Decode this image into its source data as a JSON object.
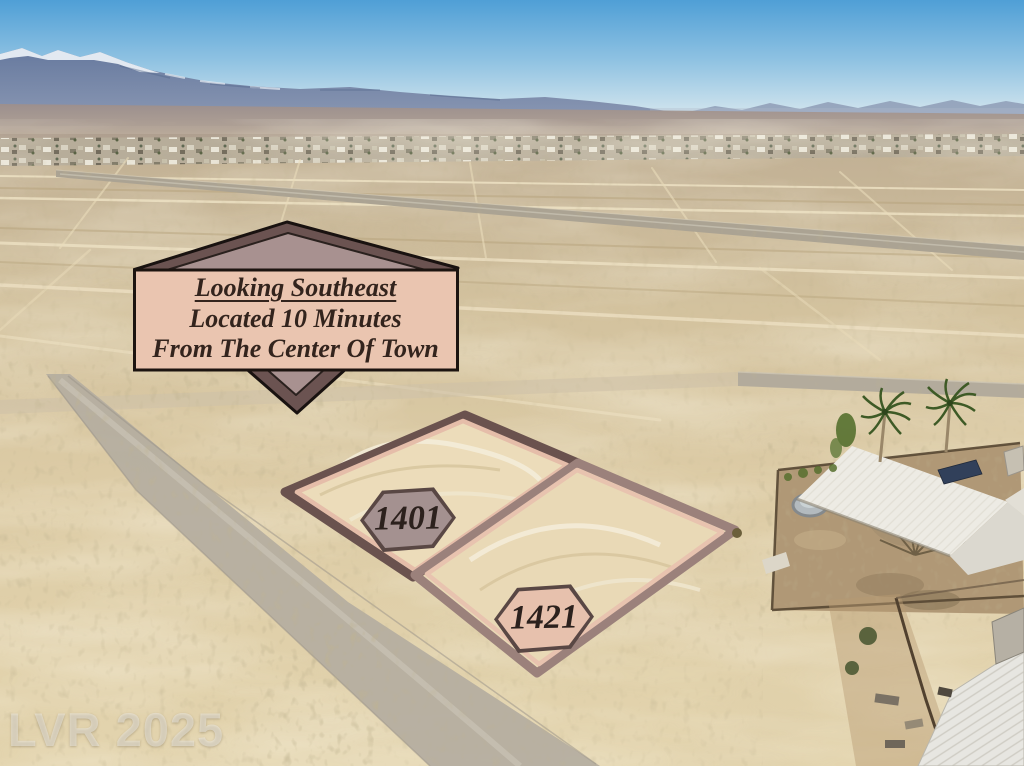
{
  "banner": {
    "line1": "Looking Southeast",
    "line2": "Located 10 Minutes",
    "line3": "From The Center Of Town"
  },
  "lots": [
    {
      "label": "1401"
    },
    {
      "label": "1421"
    }
  ],
  "watermark": "LVR 2025",
  "colors": {
    "banner_outer": "#6b5351",
    "banner_inner_triangle": "#a89190",
    "banner_panel": "#eac5b0",
    "badge_border": "#594744",
    "badge_1401_fill": "#a49190",
    "badge_1421_fill": "#e7c1ad",
    "lot_1401_outline": "#6a524e",
    "lot_1421_outline": "#9b817b",
    "lot_inner_stroke": "#e5bda9",
    "sky_top": "#4f9fd6",
    "sky_horizon": "#e6eef2",
    "desert_sand": "#ddcca6",
    "mountain": "#66799e"
  }
}
